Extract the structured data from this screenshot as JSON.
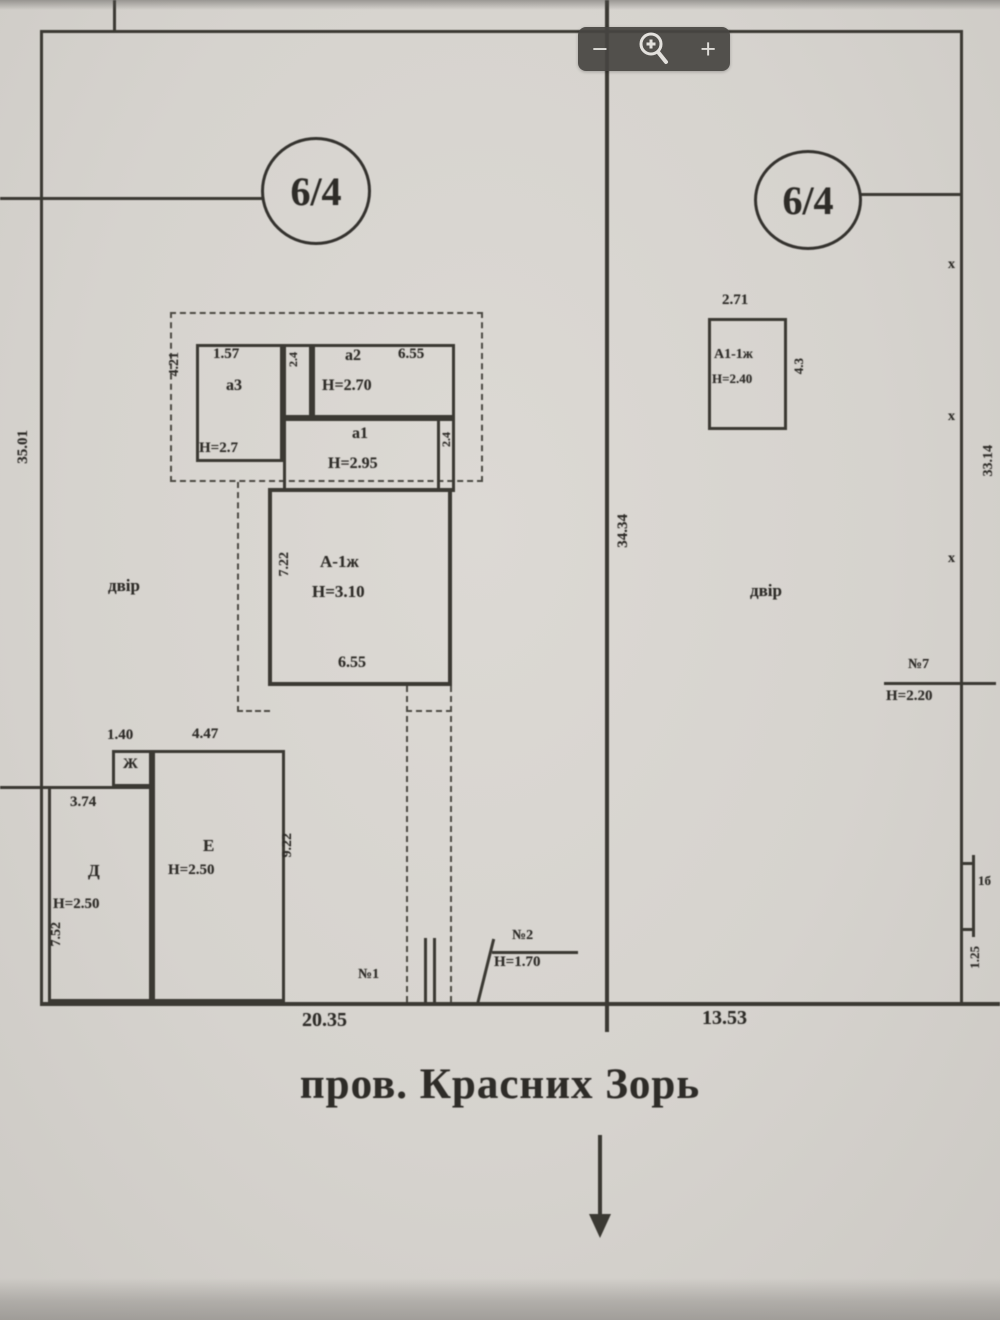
{
  "viewer": {
    "zoom_bar": {
      "minus": "−",
      "plus": "+"
    }
  },
  "plan": {
    "street_name": "пров. Красних Зорь",
    "axis_dim": "34.34",
    "left_plot": {
      "number": "6/4",
      "yard": "двір",
      "side_dim": "35.01",
      "frontage_dim": "20.35",
      "veranda": {
        "side_dim": "4.21",
        "room_a3": {
          "top_dim": "1.57",
          "label": "а3",
          "height": "Н=2.7"
        },
        "sliver_left_dim": "2.4",
        "room_a2": {
          "label": "а2",
          "width_dim": "6.55",
          "height": "Н=2.70"
        },
        "room_a1": {
          "label": "а1",
          "height": "Н=2.95",
          "side_dim": "2.4"
        }
      },
      "house": {
        "label": "А-1ж",
        "height": "Н=3.10",
        "side_dim": "7.22",
        "bottom_dim": "6.55"
      },
      "shed_zh": {
        "label": "Ж",
        "top_dim": "1.40"
      },
      "shed_e": {
        "label": "Е",
        "height": "Н=2.50",
        "top_dim": "4.47",
        "side_dim": "9.22"
      },
      "shed_d": {
        "label": "Д",
        "height": "Н=2.50",
        "top_dim": "3.74",
        "side_dim": "7.52"
      },
      "gate1": {
        "label": "№1"
      },
      "gate2": {
        "label": "№2",
        "height": "Н=1.70"
      }
    },
    "right_plot": {
      "number": "6/4",
      "yard": "двір",
      "frontage_dim": "13.53",
      "summer_house": {
        "top_dim": "2.71",
        "label": "А1-1ж",
        "height": "Н=2.40",
        "side_dim": "4.3"
      },
      "fence7": {
        "label": "№7",
        "height": "Н=2.20"
      },
      "edge_dim": "33.14",
      "edge_marks": [
        "х",
        "х",
        "х"
      ],
      "edge_small_label": "1б",
      "edge_small_dim": "1.25"
    }
  }
}
